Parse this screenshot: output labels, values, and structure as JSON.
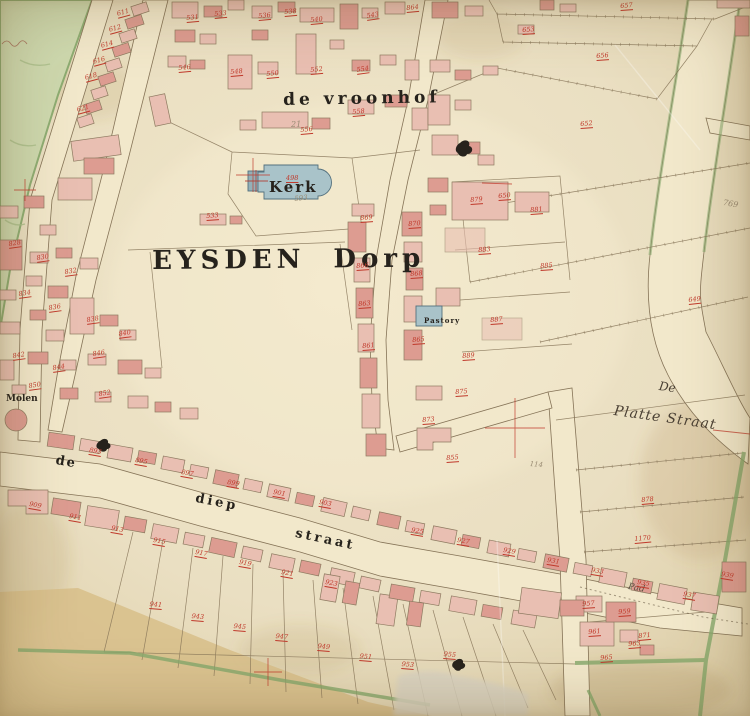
{
  "map": {
    "labels": {
      "vroonhof": "de vroonhof",
      "village": "EYSDEN Dorp",
      "church": "Kerk",
      "rectory": "Pastory",
      "mill": "Molen",
      "diep_de": "de",
      "diep_mid": "diep",
      "diep_straat": "straat",
      "platte_de": "De",
      "platte_straat": "Platte Straat",
      "path": "Pad"
    },
    "pencil_notes": [
      {
        "text": "21",
        "x": 291,
        "y": 120,
        "r": 0,
        "size": 8
      },
      {
        "text": "593",
        "x": 294,
        "y": 195,
        "r": -6,
        "size": 7
      },
      {
        "text": "769",
        "x": 724,
        "y": 198,
        "r": 10,
        "size": 8
      },
      {
        "text": "114",
        "x": 530,
        "y": 460,
        "r": 5,
        "size": 7
      }
    ],
    "parcel_numbers": [
      {
        "t": "611",
        "x": 116,
        "y": 10,
        "r": -15
      },
      {
        "t": "612",
        "x": 108,
        "y": 26,
        "r": -15
      },
      {
        "t": "614",
        "x": 100,
        "y": 42,
        "r": -15
      },
      {
        "t": "616",
        "x": 92,
        "y": 58,
        "r": -15
      },
      {
        "t": "618",
        "x": 84,
        "y": 74,
        "r": -15
      },
      {
        "t": "621",
        "x": 76,
        "y": 106,
        "r": -15
      },
      {
        "t": "531",
        "x": 186,
        "y": 14,
        "r": -5
      },
      {
        "t": "533",
        "x": 214,
        "y": 10,
        "r": -5
      },
      {
        "t": "536",
        "x": 258,
        "y": 12,
        "r": -5
      },
      {
        "t": "538",
        "x": 284,
        "y": 8,
        "r": -5
      },
      {
        "t": "540",
        "x": 310,
        "y": 16,
        "r": -5
      },
      {
        "t": "543",
        "x": 366,
        "y": 12,
        "r": -8
      },
      {
        "t": "546",
        "x": 178,
        "y": 64,
        "r": -5
      },
      {
        "t": "548",
        "x": 230,
        "y": 68,
        "r": -5
      },
      {
        "t": "550",
        "x": 266,
        "y": 70,
        "r": -5
      },
      {
        "t": "552",
        "x": 310,
        "y": 66,
        "r": -5
      },
      {
        "t": "554",
        "x": 356,
        "y": 66,
        "r": -8
      },
      {
        "t": "556",
        "x": 300,
        "y": 126,
        "r": -5
      },
      {
        "t": "558",
        "x": 352,
        "y": 108,
        "r": -5
      },
      {
        "t": "864",
        "x": 406,
        "y": 4,
        "r": -5
      },
      {
        "t": "653",
        "x": 522,
        "y": 26,
        "r": -4
      },
      {
        "t": "656",
        "x": 596,
        "y": 52,
        "r": -4
      },
      {
        "t": "657",
        "x": 620,
        "y": 2,
        "r": -4
      },
      {
        "t": "652",
        "x": 580,
        "y": 120,
        "r": -4
      },
      {
        "t": "650",
        "x": 498,
        "y": 192,
        "r": -4
      },
      {
        "t": "649",
        "x": 688,
        "y": 296,
        "r": -6
      },
      {
        "t": "498",
        "x": 286,
        "y": 174,
        "r": 0
      },
      {
        "t": "533",
        "x": 206,
        "y": 212,
        "r": -4
      },
      {
        "t": "828",
        "x": 8,
        "y": 240,
        "r": -8
      },
      {
        "t": "830",
        "x": 36,
        "y": 254,
        "r": -8
      },
      {
        "t": "832",
        "x": 64,
        "y": 268,
        "r": -8
      },
      {
        "t": "834",
        "x": 18,
        "y": 290,
        "r": -8
      },
      {
        "t": "836",
        "x": 48,
        "y": 304,
        "r": -8
      },
      {
        "t": "838",
        "x": 86,
        "y": 316,
        "r": -8
      },
      {
        "t": "840",
        "x": 118,
        "y": 330,
        "r": -8
      },
      {
        "t": "842",
        "x": 12,
        "y": 352,
        "r": -8
      },
      {
        "t": "844",
        "x": 52,
        "y": 364,
        "r": -8
      },
      {
        "t": "846",
        "x": 92,
        "y": 350,
        "r": -8
      },
      {
        "t": "850",
        "x": 28,
        "y": 382,
        "r": -8
      },
      {
        "t": "852",
        "x": 98,
        "y": 390,
        "r": -8
      },
      {
        "t": "869",
        "x": 360,
        "y": 214,
        "r": -4
      },
      {
        "t": "870",
        "x": 408,
        "y": 220,
        "r": -4
      },
      {
        "t": "866",
        "x": 356,
        "y": 262,
        "r": -4
      },
      {
        "t": "868",
        "x": 410,
        "y": 270,
        "r": -4
      },
      {
        "t": "863",
        "x": 358,
        "y": 300,
        "r": -4
      },
      {
        "t": "865",
        "x": 412,
        "y": 336,
        "r": -4
      },
      {
        "t": "861",
        "x": 362,
        "y": 342,
        "r": -4
      },
      {
        "t": "875",
        "x": 455,
        "y": 388,
        "r": -4
      },
      {
        "t": "873",
        "x": 422,
        "y": 416,
        "r": -4
      },
      {
        "t": "855",
        "x": 446,
        "y": 454,
        "r": -4
      },
      {
        "t": "879",
        "x": 470,
        "y": 196,
        "r": -4
      },
      {
        "t": "881",
        "x": 530,
        "y": 206,
        "r": -4
      },
      {
        "t": "883",
        "x": 478,
        "y": 246,
        "r": -4
      },
      {
        "t": "885",
        "x": 540,
        "y": 262,
        "r": -4
      },
      {
        "t": "887",
        "x": 490,
        "y": 316,
        "r": -4
      },
      {
        "t": "889",
        "x": 462,
        "y": 352,
        "r": -4
      },
      {
        "t": "893",
        "x": 90,
        "y": 446,
        "r": 10
      },
      {
        "t": "895",
        "x": 136,
        "y": 456,
        "r": 10
      },
      {
        "t": "897",
        "x": 182,
        "y": 468,
        "r": 10
      },
      {
        "t": "899",
        "x": 228,
        "y": 478,
        "r": 10
      },
      {
        "t": "901",
        "x": 274,
        "y": 488,
        "r": 10
      },
      {
        "t": "903",
        "x": 320,
        "y": 498,
        "r": 10
      },
      {
        "t": "909",
        "x": 30,
        "y": 500,
        "r": 10
      },
      {
        "t": "911",
        "x": 70,
        "y": 512,
        "r": 10
      },
      {
        "t": "913",
        "x": 112,
        "y": 524,
        "r": 10
      },
      {
        "t": "915",
        "x": 154,
        "y": 536,
        "r": 10
      },
      {
        "t": "917",
        "x": 196,
        "y": 548,
        "r": 10
      },
      {
        "t": "919",
        "x": 240,
        "y": 558,
        "r": 10
      },
      {
        "t": "921",
        "x": 282,
        "y": 568,
        "r": 10
      },
      {
        "t": "923",
        "x": 326,
        "y": 578,
        "r": 10
      },
      {
        "t": "925",
        "x": 412,
        "y": 526,
        "r": 9
      },
      {
        "t": "927",
        "x": 458,
        "y": 536,
        "r": 9
      },
      {
        "t": "929",
        "x": 504,
        "y": 546,
        "r": 9
      },
      {
        "t": "931",
        "x": 548,
        "y": 556,
        "r": 9
      },
      {
        "t": "933",
        "x": 592,
        "y": 566,
        "r": 9
      },
      {
        "t": "935",
        "x": 638,
        "y": 578,
        "r": 9
      },
      {
        "t": "937",
        "x": 684,
        "y": 590,
        "r": 9
      },
      {
        "t": "939",
        "x": 722,
        "y": 570,
        "r": 9
      },
      {
        "t": "941",
        "x": 150,
        "y": 600,
        "r": 5
      },
      {
        "t": "943",
        "x": 192,
        "y": 612,
        "r": 5
      },
      {
        "t": "945",
        "x": 234,
        "y": 622,
        "r": 5
      },
      {
        "t": "947",
        "x": 276,
        "y": 632,
        "r": 5
      },
      {
        "t": "949",
        "x": 318,
        "y": 642,
        "r": 5
      },
      {
        "t": "951",
        "x": 360,
        "y": 652,
        "r": 5
      },
      {
        "t": "953",
        "x": 402,
        "y": 660,
        "r": 5
      },
      {
        "t": "955",
        "x": 444,
        "y": 650,
        "r": 5
      },
      {
        "t": "957",
        "x": 582,
        "y": 600,
        "r": -4
      },
      {
        "t": "959",
        "x": 618,
        "y": 608,
        "r": -4
      },
      {
        "t": "961",
        "x": 588,
        "y": 628,
        "r": -4
      },
      {
        "t": "963",
        "x": 628,
        "y": 640,
        "r": -4
      },
      {
        "t": "965",
        "x": 600,
        "y": 654,
        "r": -4
      },
      {
        "t": "878",
        "x": 641,
        "y": 496,
        "r": -5
      },
      {
        "t": "1170",
        "x": 634,
        "y": 535,
        "r": -5
      },
      {
        "t": "871",
        "x": 638,
        "y": 632,
        "r": -5
      }
    ],
    "colors": {
      "paper": "#eadfc2",
      "paper_light": "#f3ead0",
      "paper_dark": "#d9c9a4",
      "street": "#f2e8cb",
      "building_pink": "#e9bfb2",
      "building_dark": "#dd9c91",
      "building_stroke": "#8d7a60",
      "church_blue": "#a9c3c9",
      "church_stroke": "#53707e",
      "field_green": "#ccd9ae",
      "hedge_green": "#85a86b",
      "field_tan": "#d8c08c",
      "line_brown": "#857357",
      "number_red": "#c0392b",
      "ink_black": "#26221c",
      "pencil_grey": "#998b73"
    }
  }
}
